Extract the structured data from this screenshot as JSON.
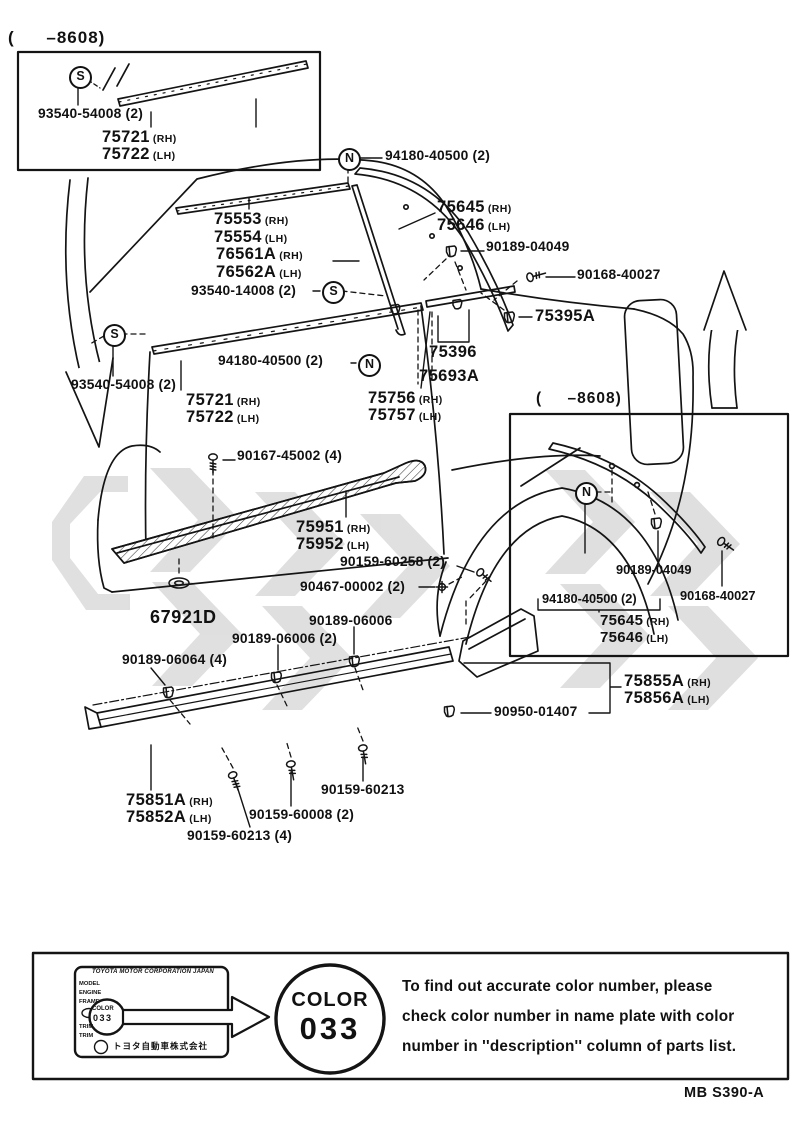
{
  "colors": {
    "ink": "#111111",
    "watermark": "#c6c6c6"
  },
  "insets": {
    "top_left_caption": "( –8608)",
    "right_caption": "( –8608)"
  },
  "symbols": {
    "s": "S",
    "n": "N"
  },
  "labels": [
    {
      "text": "93540-54008 (2)"
    },
    {
      "text": "75721",
      "side": "(RH)"
    },
    {
      "text": "75722",
      "side": "(LH)"
    },
    {
      "text": "94180-40500 (2)"
    },
    {
      "text": "75553",
      "side": "(RH)"
    },
    {
      "text": "75554",
      "side": "(LH)"
    },
    {
      "text": "76561A",
      "side": "(RH)"
    },
    {
      "text": "76562A",
      "side": "(LH)"
    },
    {
      "text": "93540-14008 (2)"
    },
    {
      "text": "75645",
      "side": "(RH)"
    },
    {
      "text": "75646",
      "side": "(LH)"
    },
    {
      "text": "90189-04049"
    },
    {
      "text": "90168-40027"
    },
    {
      "text": "75395A"
    },
    {
      "text": "75396"
    },
    {
      "text": "75693A"
    },
    {
      "text": "93540-54008 (2)"
    },
    {
      "text": "94180-40500 (2)"
    },
    {
      "text": "75721",
      "side": "(RH)"
    },
    {
      "text": "75722",
      "side": "(LH)"
    },
    {
      "text": "75756",
      "side": "(RH)"
    },
    {
      "text": "75757",
      "side": "(LH)"
    },
    {
      "text": "90167-45002 (4)"
    },
    {
      "text": "75951",
      "side": "(RH)"
    },
    {
      "text": "75952",
      "side": "(LH)"
    },
    {
      "text": "90159-60258 (2)"
    },
    {
      "text": "90467-00002 (2)"
    },
    {
      "text": "67921D"
    },
    {
      "text": "90189-06006"
    },
    {
      "text": "90189-06006 (2)"
    },
    {
      "text": "90189-06064 (4)"
    },
    {
      "text": "90189-04049"
    },
    {
      "text": "94180-40500 (2)"
    },
    {
      "text": "90168-40027"
    },
    {
      "text": "75645",
      "side": "(RH)"
    },
    {
      "text": "75646",
      "side": "(LH)"
    },
    {
      "text": "75855A",
      "side": "(RH)"
    },
    {
      "text": "75856A",
      "side": "(LH)"
    },
    {
      "text": "90950-01407"
    },
    {
      "text": "75851A",
      "side": "(RH)"
    },
    {
      "text": "75852A",
      "side": "(LH)"
    },
    {
      "text": "90159-60213"
    },
    {
      "text": "90159-60008 (2)"
    },
    {
      "text": "90159-60213 (4)"
    }
  ],
  "name_plate": {
    "header": "TOYOTA MOTOR CORPORATION JAPAN",
    "rows": [
      "MODEL",
      "ENGINE",
      "FRAME"
    ],
    "trim_rows": [
      "TRIM",
      "TRIM"
    ],
    "color_label": "COLOR",
    "color_value": "033",
    "company": "トヨタ自動車株式会社"
  },
  "color_badge": {
    "label": "COLOR",
    "value": "033"
  },
  "note": {
    "line1": "To find out accurate color number, please",
    "line2": "check color number in name plate with color",
    "line3": "number in ''description'' column of parts list."
  },
  "footer_code": "MB S390-A"
}
